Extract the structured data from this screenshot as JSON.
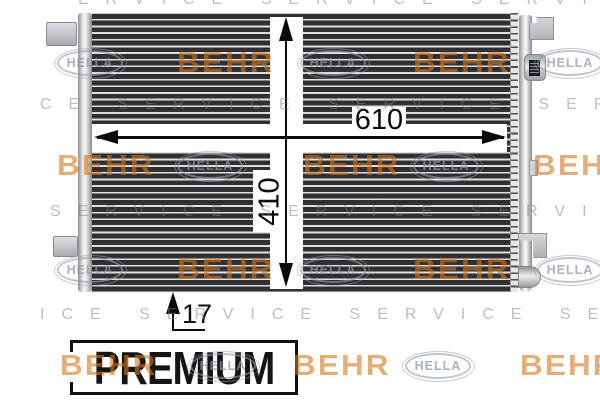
{
  "drawing": {
    "width_label": "610",
    "height_label": "410",
    "depth_label": "17"
  },
  "banner": {
    "premium_label": "PREMIUM",
    "line_letters": [
      "L",
      "I",
      "N",
      "E"
    ],
    "black_box_color": "#141414"
  },
  "watermark": {
    "behr_text": "BEHR",
    "hella_text": "HELLA",
    "behr_orange": "#d6771a",
    "hella_grey": "#949ead",
    "service_grey": "#7d7d7d",
    "service_rows": [
      "ERVICE SERVICE SERVICE",
      "CE SERVICE SERVICE SERV",
      "SERVICE SERVICE SERVICE",
      "ICE SERVICE SERVICE SER"
    ]
  }
}
